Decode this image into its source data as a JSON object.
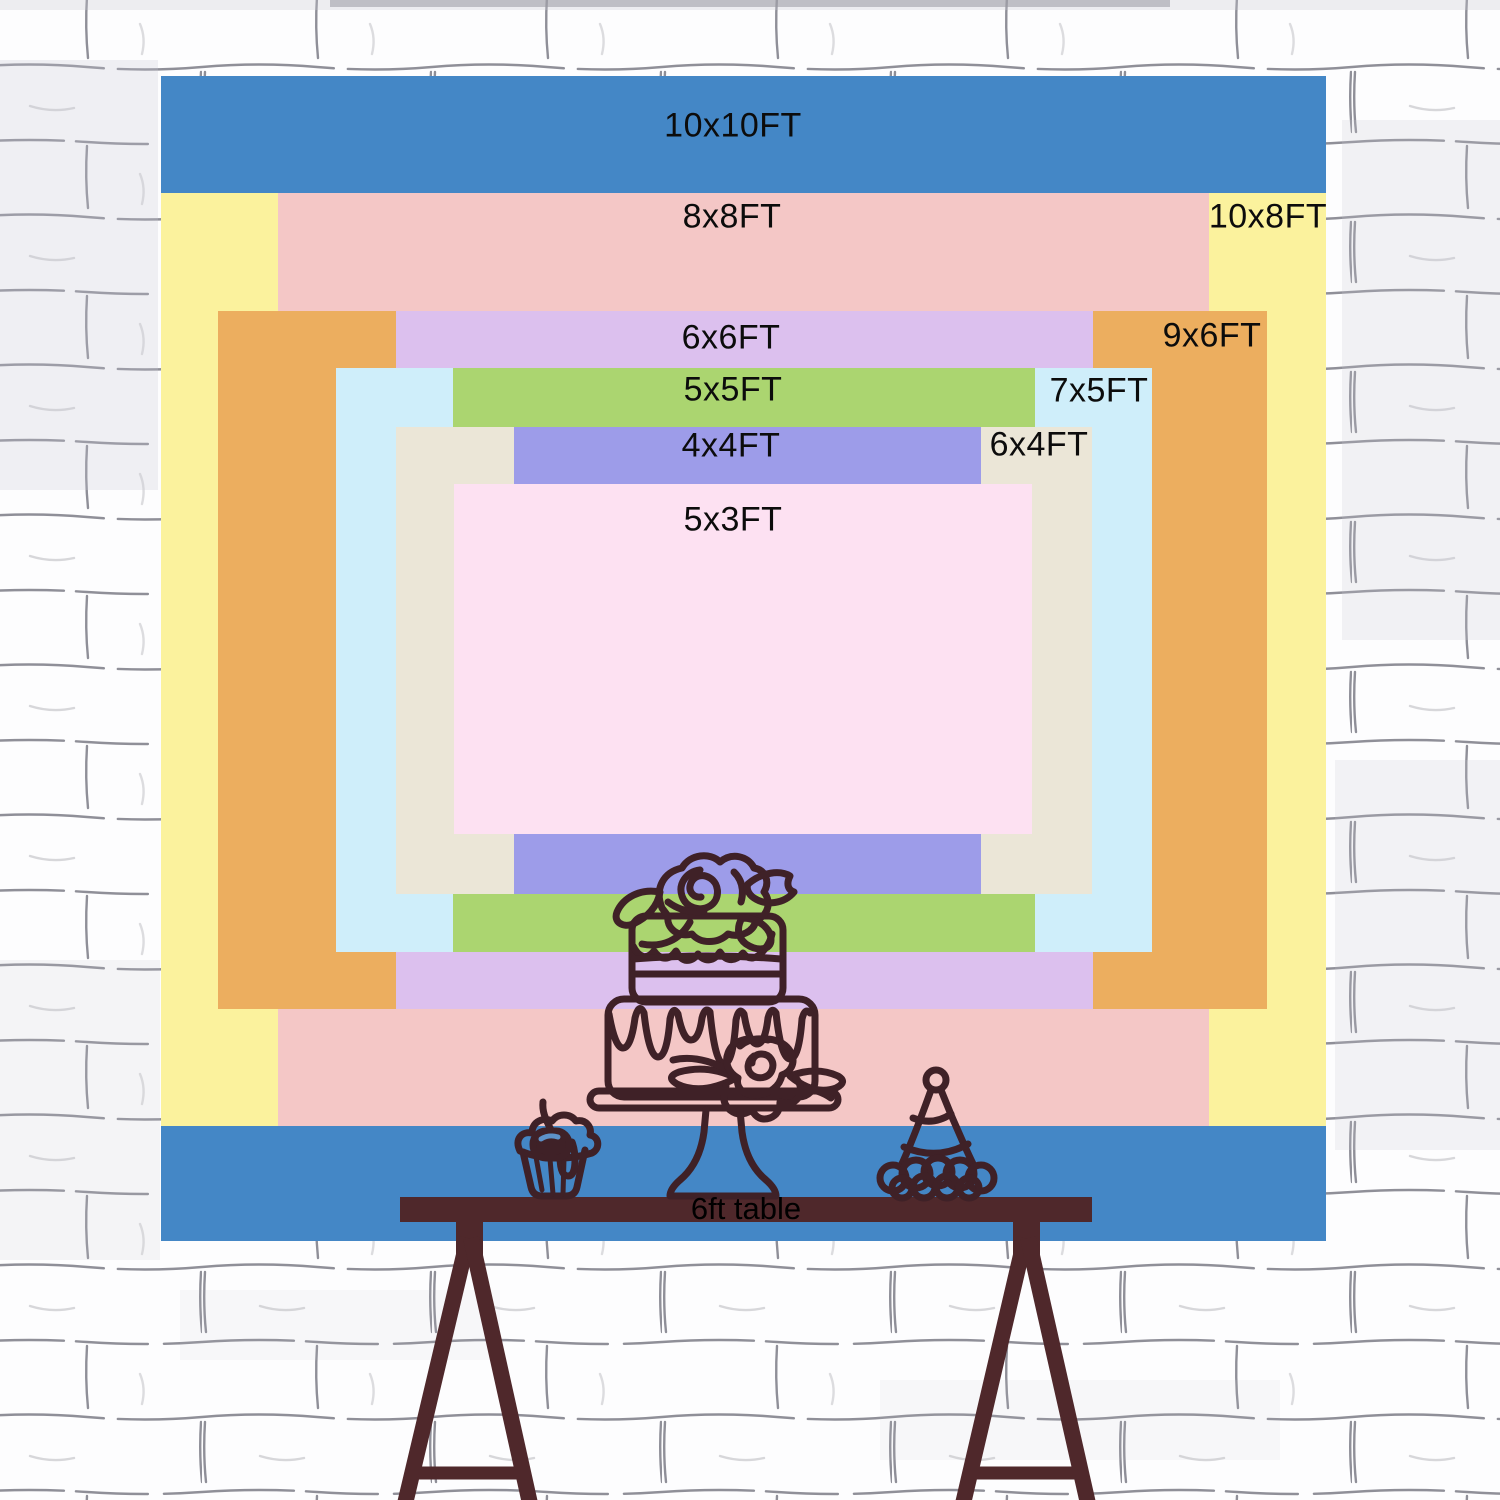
{
  "backdrop_sizes": [
    {
      "id": "10x10",
      "label": "10x10FT",
      "color": "#4487c6"
    },
    {
      "id": "10x8",
      "label": "10x8FT",
      "color": "#fbf29d"
    },
    {
      "id": "8x8",
      "label": "8x8FT",
      "color": "#f4c7c6"
    },
    {
      "id": "9x6",
      "label": "9x6FT",
      "color": "#ecae5f"
    },
    {
      "id": "6x6",
      "label": "6x6FT",
      "color": "#dcc0ee"
    },
    {
      "id": "7x5",
      "label": "7x5FT",
      "color": "#cfeefa"
    },
    {
      "id": "5x5",
      "label": "5x5FT",
      "color": "#abd570"
    },
    {
      "id": "6x4",
      "label": "6x4FT",
      "color": "#ebe6d7"
    },
    {
      "id": "4x4",
      "label": "4x4FT",
      "color": "#9d9ce9"
    },
    {
      "id": "5x3",
      "label": "5x3FT",
      "color": "#fde1f2"
    }
  ],
  "scene": {
    "table_label": "6ft table"
  },
  "illustration": {
    "line_color": "#3f2127",
    "table_color": "#4f282b",
    "cherry_highlight": "#5d92c9"
  },
  "wall": {
    "brick_color": "#fdfdfe",
    "mortar_color": "#8f8f98"
  }
}
